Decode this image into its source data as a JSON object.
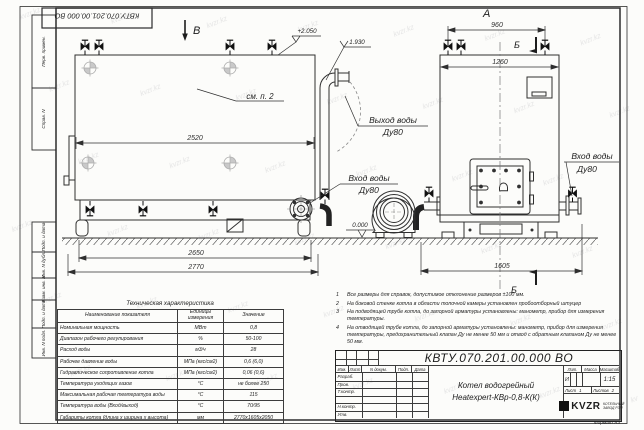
{
  "watermark": {
    "text": "kvzr.kz"
  },
  "corner_stamp": "КВТУ.070.201.00.000  ВО",
  "margin": {
    "labels": [
      "Перв. примен.",
      "Справ. N",
      "Подп. и дата",
      "Инв. N дубл.",
      "Взам. инв. N",
      "Подп. и дата",
      "Инв. N подл."
    ]
  },
  "drawing": {
    "view_b": "В",
    "view_a": "А",
    "section_b": "Б",
    "see_item": "см. п. 2",
    "elev_roof": "+2.050",
    "elev_pipe": "1.930",
    "elev_ground": "0.000",
    "outlet": {
      "line1": "Выход воды",
      "line2": "Ду80"
    },
    "inlet_left": {
      "line1": "Вход воды",
      "line2": "Ду80"
    },
    "inlet_right": {
      "line1": "Вход воды",
      "line2": "Ду80"
    },
    "dims": {
      "shell_len": "2520",
      "skid_len": "2650",
      "total_len": "2770",
      "front_top": "960",
      "front_width": "1260",
      "front_base": "1605"
    }
  },
  "tech_table": {
    "title": "Техническая характеристика",
    "headers": [
      "Наименование показателя",
      "Единицы измерения",
      "Значение"
    ],
    "rows": [
      {
        "name": "Номинальная мощность",
        "unit": "МВт",
        "value": "0,8"
      },
      {
        "name": "Диапазон рабочего регулирования",
        "unit": "%",
        "value": "50-100"
      },
      {
        "name": "Расход воды",
        "unit": "м3/ч",
        "value": "28"
      },
      {
        "name": "Рабочее давление воды",
        "unit": "МПа (кгс/см2)",
        "value": "0,6 (6,0)"
      },
      {
        "name": "Гидравлическое сопротивление котла",
        "unit": "МПа (кгс/см2)",
        "value": "0,06 (0,6)"
      },
      {
        "name": "Температура уходящих газов",
        "unit": "°С",
        "value": "не более 250"
      },
      {
        "name": "Максимальная рабочая температура воды",
        "unit": "°С",
        "value": "115"
      },
      {
        "name": "Температура воды (Вход/выход)",
        "unit": "°С",
        "value": "70/95"
      },
      {
        "name": "Габариты котла (длина х ширина х высота)",
        "unit": "мм",
        "value": "2770х1605х2050"
      }
    ]
  },
  "notes": {
    "items": [
      {
        "n": "1",
        "text": "Все размеры для справок, допустимое отклонение размеров ±100 мм."
      },
      {
        "n": "2",
        "text": "На боковой стенке котла в области топочной камеры установлен пробоотборный штуцер"
      },
      {
        "n": "3",
        "text": "На подводящей трубе котла, до запорной арматуры установлены: манометр, прибор для измерения температуры."
      },
      {
        "n": "4",
        "text": "На отводящей трубе котла, до запорной арматуры установлены: манометр, прибор для измерения температуры, предохранительный клапан Ду не менее 50 мм и отвод с обратным клапаном Ду не менее 50 мм."
      }
    ]
  },
  "title_block": {
    "doc_number": "КВТУ.070.201.00.000  ВО",
    "product_line1": "Котел водогрейный",
    "product_line2": "Heatexpert-КВр-0,8-К(К)",
    "cols": {
      "izm": "Изм.",
      "list": "Лист",
      "ndoc": "N докум.",
      "podp": "Подп.",
      "data": "Дата"
    },
    "rows": {
      "razrab": "Разраб.",
      "prov": "Пров.",
      "tkontr": "Т.контр.",
      "nkontr": "Н.контр.",
      "utv": "Утв."
    },
    "lit_label": "Лит.",
    "lit_value": "И",
    "massa_label": "Масса",
    "scale_label": "Масштаб",
    "scale_value": "1:15",
    "sheet_label": "Лист",
    "sheet_value": "1",
    "sheets_label": "Листов",
    "sheets_value": "2",
    "logo_text": "KVZR",
    "logo_sub1": "КОТЕЛЬНЫЙ",
    "logo_sub2": "ЗАВОД РЭП"
  },
  "format_label": "Формат  А3"
}
